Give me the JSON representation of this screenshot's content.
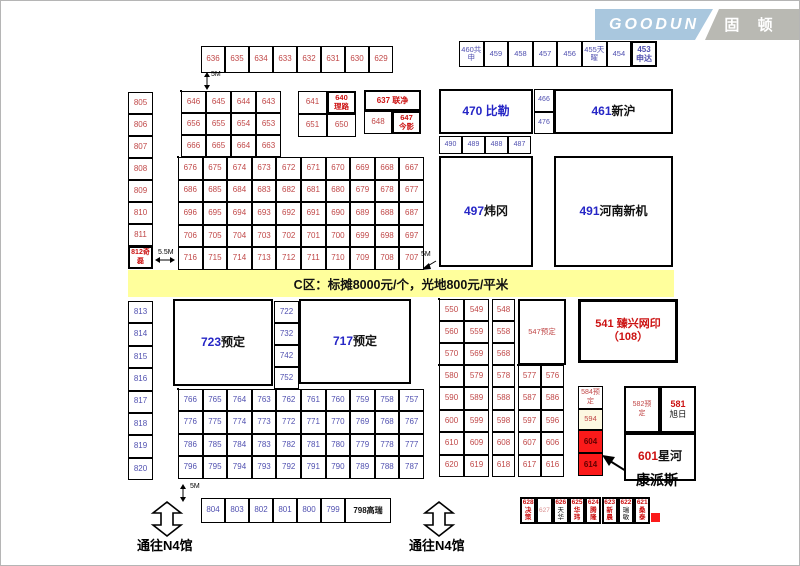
{
  "logo": {
    "en": "GOODUN",
    "cn": "固 顿",
    "blue": "#a9c7de",
    "gray": "#b9b9b3"
  },
  "banner": {
    "text": "C区：标摊8000元/个，光地800元/平米",
    "bg": "#ffff9c"
  },
  "colors": {
    "red": "#c04848",
    "blue": "#5050b0",
    "bblue": "#2626c6",
    "dred": "#cc1212",
    "black": "#111111",
    "pink": "#d98f8f",
    "maroon": "#600000"
  },
  "grids": [
    {
      "id": "strip-top",
      "x": 200,
      "y": 45,
      "cw": 24,
      "ch": 27,
      "c": "red",
      "fs": 8,
      "ob": 1,
      "rows": [
        [
          "636",
          "635",
          "634",
          "633",
          "632",
          "631",
          "630",
          "629"
        ]
      ]
    },
    {
      "id": "strip-ne",
      "x": 458,
      "y": 40,
      "cw": 24.6,
      "ch": 26,
      "c": "blue",
      "fs": 7.5,
      "ob": 1,
      "rows": [
        [
          "460共\n申",
          "459",
          "458",
          "457",
          "456",
          "455天\n曜",
          "454"
        ]
      ]
    },
    {
      "id": "col-805",
      "x": 127,
      "y": 91,
      "cw": 25,
      "ch": 22,
      "c": "red",
      "fs": 8,
      "ob": 1,
      "rows": [
        [
          "805"
        ],
        [
          "806"
        ],
        [
          "807"
        ],
        [
          "808"
        ],
        [
          "809"
        ],
        [
          "810"
        ],
        [
          "811"
        ]
      ]
    },
    {
      "id": "block-a",
      "x": 180,
      "y": 90,
      "cw": 25,
      "ch": 22,
      "c": "red",
      "fs": 8,
      "ob": 2,
      "rows": [
        [
          "646",
          "645",
          "644",
          "643"
        ],
        [
          "656",
          "655",
          "654",
          "653"
        ],
        [
          "666",
          "665",
          "664",
          "663"
        ]
      ]
    },
    {
      "id": "block-b",
      "x": 297,
      "y": 90,
      "cw": 29,
      "ch": 23,
      "c": "red",
      "fs": 8,
      "ob": 1,
      "rows": [
        [
          "641",
          ""
        ],
        [
          "651",
          "650"
        ]
      ]
    },
    {
      "id": "cell-648",
      "x": 363,
      "y": 110,
      "cw": 28,
      "ch": 23,
      "c": "red",
      "fs": 8,
      "ob": 1,
      "rows": [
        [
          "648"
        ]
      ]
    },
    {
      "id": "grid-main",
      "x": 177,
      "y": 156,
      "cw": 24.6,
      "ch": 22.6,
      "c": "red",
      "fs": 8,
      "ob": 2,
      "rows": [
        [
          "676",
          "675",
          "674",
          "673",
          "672",
          "671",
          "670",
          "669",
          "668",
          "667"
        ],
        [
          "686",
          "685",
          "684",
          "683",
          "682",
          "681",
          "680",
          "679",
          "678",
          "677"
        ],
        [
          "696",
          "695",
          "694",
          "693",
          "692",
          "691",
          "690",
          "689",
          "688",
          "687"
        ],
        [
          "706",
          "705",
          "704",
          "703",
          "702",
          "701",
          "700",
          "699",
          "698",
          "697"
        ],
        [
          "716",
          "715",
          "714",
          "713",
          "712",
          "711",
          "710",
          "709",
          "708",
          "707"
        ]
      ]
    },
    {
      "id": "cells-466",
      "x": 533,
      "y": 88,
      "cw": 20,
      "ch": 22.5,
      "c": "blue",
      "fs": 7,
      "ob": 1,
      "rows": [
        [
          "466"
        ],
        [
          "476"
        ]
      ]
    },
    {
      "id": "row-490",
      "x": 438,
      "y": 135,
      "cw": 23,
      "ch": 18,
      "c": "blue",
      "fs": 7,
      "ob": 1,
      "rows": [
        [
          "490",
          "489",
          "488",
          "487"
        ]
      ]
    },
    {
      "id": "col-813",
      "x": 127,
      "y": 300,
      "cw": 25,
      "ch": 22.4,
      "c": "blue",
      "fs": 8,
      "ob": 1,
      "rows": [
        [
          "813"
        ],
        [
          "814"
        ],
        [
          "815"
        ],
        [
          "816"
        ],
        [
          "817"
        ],
        [
          "818"
        ],
        [
          "819"
        ],
        [
          "820"
        ]
      ]
    },
    {
      "id": "col-722",
      "x": 273,
      "y": 300,
      "cw": 25,
      "ch": 22,
      "c": "blue",
      "fs": 8,
      "ob": 1,
      "rows": [
        [
          "722"
        ],
        [
          "732"
        ],
        [
          "742"
        ],
        [
          "752"
        ]
      ]
    },
    {
      "id": "grid-lower",
      "x": 177,
      "y": 388,
      "cw": 24.6,
      "ch": 22.4,
      "c": "blue",
      "fs": 8,
      "ob": 2,
      "rows": [
        [
          "766",
          "765",
          "764",
          "763",
          "762",
          "761",
          "760",
          "759",
          "758",
          "757"
        ],
        [
          "776",
          "775",
          "774",
          "773",
          "772",
          "771",
          "770",
          "769",
          "768",
          "767"
        ],
        [
          "786",
          "785",
          "784",
          "783",
          "782",
          "781",
          "780",
          "779",
          "778",
          "777"
        ],
        [
          "796",
          "795",
          "794",
          "793",
          "792",
          "791",
          "790",
          "789",
          "788",
          "787"
        ]
      ]
    },
    {
      "id": "mid-a",
      "x": 438,
      "y": 298,
      "cw": 25,
      "ch": 22,
      "c": "red",
      "fs": 8,
      "ob": 2,
      "rows": [
        [
          "550",
          "549"
        ],
        [
          "560",
          "559"
        ],
        [
          "570",
          "569"
        ]
      ]
    },
    {
      "id": "mid-b",
      "x": 491,
      "y": 298,
      "cw": 23,
      "ch": 22,
      "c": "red",
      "fs": 8,
      "ob": 1,
      "rows": [
        [
          "548"
        ],
        [
          "558"
        ],
        [
          "568"
        ]
      ]
    },
    {
      "id": "mid-c",
      "x": 438,
      "y": 364,
      "cw": 25,
      "ch": 22.4,
      "c": "red",
      "fs": 8,
      "ob": 2,
      "rows": [
        [
          "580",
          "579"
        ],
        [
          "590",
          "589"
        ],
        [
          "600",
          "599"
        ],
        [
          "610",
          "609"
        ],
        [
          "620",
          "619"
        ]
      ]
    },
    {
      "id": "mid-d",
      "x": 491,
      "y": 364,
      "cw": 23,
      "ch": 22.4,
      "c": "red",
      "fs": 8,
      "ob": 1,
      "rows": [
        [
          "578"
        ],
        [
          "588"
        ],
        [
          "598"
        ],
        [
          "608"
        ],
        [
          "618"
        ]
      ]
    },
    {
      "id": "mid-e",
      "x": 517,
      "y": 364,
      "cw": 23,
      "ch": 22.4,
      "c": "red",
      "fs": 8,
      "ob": 2,
      "rows": [
        [
          "577",
          "576"
        ],
        [
          "587",
          "586"
        ],
        [
          "597",
          "596"
        ],
        [
          "607",
          "606"
        ],
        [
          "617",
          "616"
        ]
      ]
    },
    {
      "id": "row-804",
      "x": 200,
      "y": 497,
      "cw": 24,
      "ch": 25,
      "c": "blue",
      "fs": 8,
      "ob": 1,
      "rows": [
        [
          "804",
          "803",
          "802",
          "801",
          "800",
          "799"
        ]
      ]
    }
  ],
  "boxes": [
    {
      "id": "booth-453",
      "x": 630,
      "y": 40,
      "w": 26,
      "h": 26,
      "b": 2,
      "fs": 8,
      "stack": 1,
      "parts": [
        {
          "t": "453",
          "c": "blue",
          "b": 1
        },
        {
          "t": "申达",
          "c": "blue",
          "b": 1
        }
      ]
    },
    {
      "id": "booth-812",
      "x": 127,
      "y": 245,
      "w": 25,
      "h": 23,
      "b": 2,
      "fs": 7,
      "stack": 1,
      "parts": [
        {
          "t": "812奇",
          "c": "dred",
          "b": 1
        },
        {
          "t": "磊",
          "c": "dred",
          "b": 1
        }
      ]
    },
    {
      "id": "booth-640",
      "x": 326,
      "y": 90,
      "w": 29,
      "h": 23,
      "b": 2,
      "fs": 7.5,
      "stack": 1,
      "parts": [
        {
          "t": "640",
          "c": "dred",
          "b": 1
        },
        {
          "t": "理路",
          "c": "dred",
          "b": 1
        }
      ]
    },
    {
      "id": "booth-637",
      "x": 363,
      "y": 89,
      "w": 57,
      "h": 21,
      "b": 2,
      "fs": 8,
      "parts": [
        {
          "t": "637 联净",
          "c": "dred",
          "b": 1
        }
      ]
    },
    {
      "id": "booth-647",
      "x": 391,
      "y": 110,
      "w": 29,
      "h": 23,
      "b": 2,
      "fs": 7.5,
      "stack": 1,
      "parts": [
        {
          "t": "647",
          "c": "dred",
          "b": 1
        },
        {
          "t": "今影",
          "c": "dred",
          "b": 1
        }
      ]
    },
    {
      "id": "booth-470",
      "x": 438,
      "y": 88,
      "w": 94,
      "h": 45,
      "b": 2,
      "fs": 12,
      "parts": [
        {
          "t": "470 比勒",
          "c": "bblue",
          "b": 1
        }
      ]
    },
    {
      "id": "booth-461",
      "x": 553,
      "y": 88,
      "w": 119,
      "h": 45,
      "b": 2,
      "fs": 12,
      "parts": [
        {
          "t": "461 ",
          "c": "bblue",
          "b": 1
        },
        {
          "t": "新沪",
          "c": "black",
          "b": 1
        }
      ]
    },
    {
      "id": "booth-497",
      "x": 438,
      "y": 155,
      "w": 94,
      "h": 111,
      "b": 2,
      "fs": 12,
      "parts": [
        {
          "t": "497 ",
          "c": "bblue",
          "b": 1
        },
        {
          "t": "炜冈",
          "c": "black",
          "b": 1
        }
      ]
    },
    {
      "id": "booth-491",
      "x": 553,
      "y": 155,
      "w": 119,
      "h": 111,
      "b": 2,
      "fs": 12,
      "parts": [
        {
          "t": "491 ",
          "c": "bblue",
          "b": 1
        },
        {
          "t": "河南新机",
          "c": "black",
          "b": 1
        }
      ]
    },
    {
      "id": "booth-723",
      "x": 172,
      "y": 298,
      "w": 100,
      "h": 87,
      "b": 2,
      "fs": 12,
      "parts": [
        {
          "t": "723 ",
          "c": "bblue",
          "b": 1
        },
        {
          "t": "预定",
          "c": "black",
          "b": 1
        }
      ]
    },
    {
      "id": "booth-717",
      "x": 298,
      "y": 298,
      "w": 112,
      "h": 85,
      "b": 2,
      "fs": 12,
      "parts": [
        {
          "t": "717 ",
          "c": "bblue",
          "b": 1
        },
        {
          "t": "预定",
          "c": "black",
          "b": 1
        }
      ]
    },
    {
      "id": "booth-547",
      "x": 517,
      "y": 298,
      "w": 48,
      "h": 66,
      "b": 2,
      "fs": 7.5,
      "parts": [
        {
          "t": "547预定",
          "c": "red"
        }
      ]
    },
    {
      "id": "booth-541",
      "x": 577,
      "y": 298,
      "w": 100,
      "h": 64,
      "b": 3,
      "fs": 11,
      "stack": 1,
      "parts": [
        {
          "t": "541 臻兴网印",
          "c": "dred",
          "b": 1
        },
        {
          "t": "（108）",
          "c": "dred",
          "b": 1
        }
      ]
    },
    {
      "id": "booth-584",
      "x": 577,
      "y": 385,
      "w": 25,
      "h": 23,
      "b": 1,
      "fs": 7,
      "stack": 1,
      "parts": [
        {
          "t": "584预",
          "c": "red"
        },
        {
          "t": "定",
          "c": "red"
        }
      ]
    },
    {
      "id": "booth-594",
      "x": 577,
      "y": 408,
      "w": 25,
      "h": 21,
      "b": 1,
      "fs": 7.5,
      "bg": "#fdf8e1",
      "parts": [
        {
          "t": "594",
          "c": "red"
        }
      ]
    },
    {
      "id": "booth-604",
      "x": 577,
      "y": 429,
      "w": 25,
      "h": 23,
      "b": 1,
      "fs": 8,
      "bg": "#fb1a1a",
      "parts": [
        {
          "t": "604",
          "c": "maroon",
          "b": 1
        }
      ]
    },
    {
      "id": "booth-614",
      "x": 577,
      "y": 452,
      "w": 25,
      "h": 23,
      "b": 1,
      "fs": 8,
      "bg": "#fb1a1a",
      "parts": [
        {
          "t": "614",
          "c": "maroon",
          "b": 1
        }
      ]
    },
    {
      "id": "booth-582",
      "x": 623,
      "y": 385,
      "w": 36,
      "h": 47,
      "b": 2,
      "fs": 7,
      "stack": 1,
      "parts": [
        {
          "t": "582预",
          "c": "red"
        },
        {
          "t": "定",
          "c": "red"
        }
      ]
    },
    {
      "id": "booth-581",
      "x": 659,
      "y": 385,
      "w": 36,
      "h": 47,
      "b": 2,
      "fs": 9,
      "stack": 1,
      "parts": [
        {
          "t": "581",
          "c": "dred",
          "b": 1,
          "fs": 9
        },
        {
          "t": "旭日",
          "c": "black",
          "fs": 8.5
        }
      ]
    },
    {
      "id": "booth-601",
      "x": 623,
      "y": 432,
      "w": 72,
      "h": 48,
      "b": 2,
      "fs": 12,
      "parts": [
        {
          "t": "601",
          "c": "dred",
          "b": 1
        },
        {
          "t": "星河",
          "c": "black",
          "b": 1
        }
      ]
    },
    {
      "id": "booth-798",
      "x": 344,
      "y": 497,
      "w": 46,
      "h": 25,
      "b": 1.5,
      "fs": 8,
      "parts": [
        {
          "t": "798高瑞",
          "c": "black",
          "b": 1
        }
      ]
    },
    {
      "id": "booth-628",
      "x": 519,
      "y": 496,
      "w": 16.3,
      "h": 27,
      "b": 2,
      "fs": 6.5,
      "stack": 1,
      "parts": [
        {
          "t": "628",
          "c": "dred",
          "b": 1
        },
        {
          "t": "决策",
          "c": "dred",
          "b": 1
        }
      ]
    },
    {
      "id": "booth-627",
      "x": 535.3,
      "y": 496,
      "w": 16.3,
      "h": 27,
      "b": 2,
      "fs": 6.5,
      "parts": [
        {
          "t": "627",
          "c": "pink"
        }
      ]
    },
    {
      "id": "booth-626",
      "x": 551.6,
      "y": 496,
      "w": 16.3,
      "h": 27,
      "b": 2,
      "fs": 6.5,
      "stack": 1,
      "parts": [
        {
          "t": "626",
          "c": "dred",
          "b": 1
        },
        {
          "t": "天华",
          "c": "black"
        }
      ]
    },
    {
      "id": "booth-625",
      "x": 567.9,
      "y": 496,
      "w": 16.3,
      "h": 27,
      "b": 2,
      "fs": 6.5,
      "stack": 1,
      "parts": [
        {
          "t": "625",
          "c": "dred",
          "b": 1
        },
        {
          "t": "华玮",
          "c": "dred",
          "b": 1
        }
      ]
    },
    {
      "id": "booth-624",
      "x": 584.2,
      "y": 496,
      "w": 16.3,
      "h": 27,
      "b": 2,
      "fs": 6.5,
      "stack": 1,
      "parts": [
        {
          "t": "624",
          "c": "dred",
          "b": 1
        },
        {
          "t": "腾隆",
          "c": "dred",
          "b": 1
        }
      ]
    },
    {
      "id": "booth-623",
      "x": 600.5,
      "y": 496,
      "w": 16.3,
      "h": 27,
      "b": 2,
      "fs": 6.5,
      "stack": 1,
      "parts": [
        {
          "t": "623",
          "c": "dred",
          "b": 1
        },
        {
          "t": "新晨",
          "c": "dred",
          "b": 1
        }
      ]
    },
    {
      "id": "booth-622",
      "x": 616.8,
      "y": 496,
      "w": 16.3,
      "h": 27,
      "b": 2,
      "fs": 6.5,
      "stack": 1,
      "parts": [
        {
          "t": "622",
          "c": "dred",
          "b": 1
        },
        {
          "t": "瑞敏",
          "c": "black"
        }
      ]
    },
    {
      "id": "booth-621",
      "x": 633.1,
      "y": 496,
      "w": 16.3,
      "h": 27,
      "b": 2,
      "fs": 6.5,
      "stack": 1,
      "parts": [
        {
          "t": "621",
          "c": "dred",
          "b": 1
        },
        {
          "t": "桑泰",
          "c": "dred",
          "b": 1
        }
      ]
    },
    {
      "id": "red-marker",
      "x": 650,
      "y": 512,
      "w": 9,
      "h": 9,
      "b": 0,
      "bg": "#fb1a1a",
      "parts": []
    }
  ],
  "notes": [
    {
      "id": "dim-5m-top",
      "t": "5M",
      "x": 210,
      "y": 70,
      "fs": 7
    },
    {
      "id": "dim-5-5m",
      "t": "5.5M",
      "x": 157,
      "y": 248,
      "fs": 7
    },
    {
      "id": "dim-5m-mid",
      "t": "5M",
      "x": 420,
      "y": 250,
      "fs": 7
    },
    {
      "id": "dim-5m-bottom",
      "t": "5M",
      "x": 189,
      "y": 482,
      "fs": 7
    },
    {
      "id": "gate-left-label",
      "t": "通往N4馆",
      "x": 136,
      "y": 538,
      "fs": 13,
      "bold": 1
    },
    {
      "id": "gate-right-label",
      "t": "通往N4馆",
      "x": 408,
      "y": 538,
      "fs": 13,
      "bold": 1
    },
    {
      "id": "kangpaisi-label",
      "t": "康派斯",
      "x": 635,
      "y": 472,
      "fs": 14,
      "bold": 1
    }
  ]
}
